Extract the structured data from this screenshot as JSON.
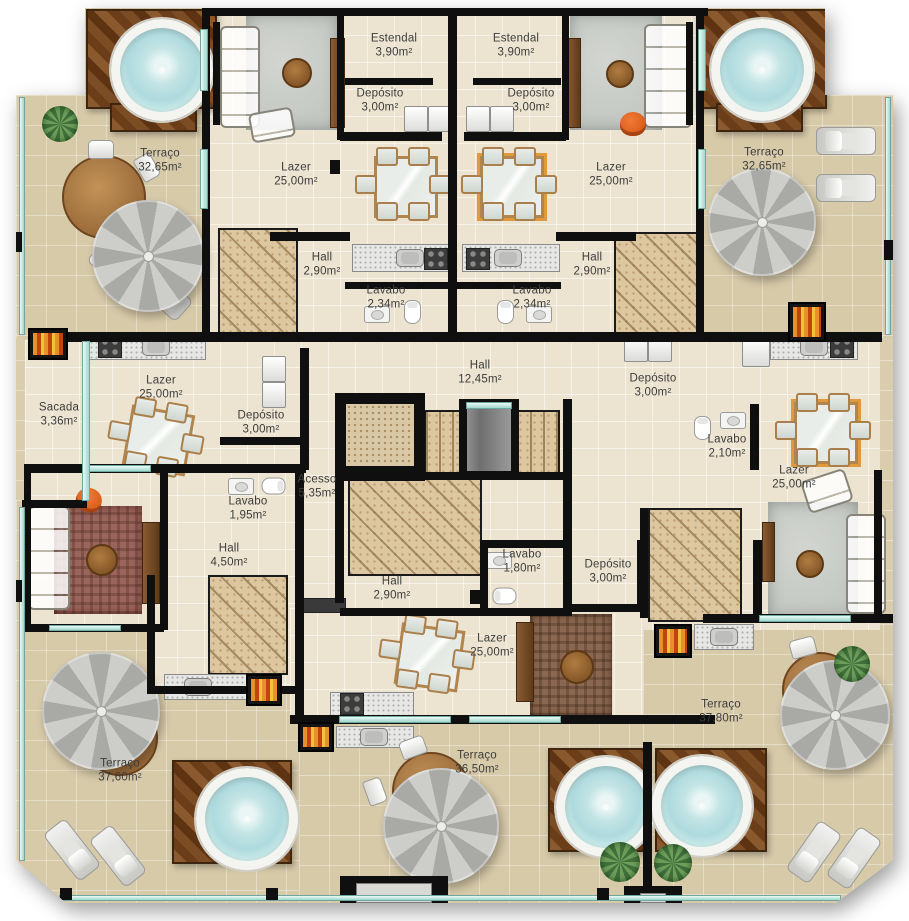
{
  "plan_meta": {
    "drawing_type": "residential penthouse floor plan, top view",
    "language": "pt-BR",
    "units": 4
  },
  "labels": [
    {
      "id": "estendal-top-left",
      "name": "Estendal",
      "area": "3,90m²"
    },
    {
      "id": "estendal-top-right",
      "name": "Estendal",
      "area": "3,90m²"
    },
    {
      "id": "deposito-top-left",
      "name": "Depósito",
      "area": "3,00m²"
    },
    {
      "id": "deposito-top-right",
      "name": "Depósito",
      "area": "3,00m²"
    },
    {
      "id": "terraco-top-left",
      "name": "Terraço",
      "area": "32,65m²"
    },
    {
      "id": "terraco-top-right",
      "name": "Terraço",
      "area": "32,65m²"
    },
    {
      "id": "lazer-top-left",
      "name": "Lazer",
      "area": "25,00m²"
    },
    {
      "id": "lazer-top-right",
      "name": "Lazer",
      "area": "25,00m²"
    },
    {
      "id": "hall-top-left",
      "name": "Hall",
      "area": "2,90m²"
    },
    {
      "id": "hall-top-right",
      "name": "Hall",
      "area": "2,90m²"
    },
    {
      "id": "lavabo-top-left",
      "name": "Lavabo",
      "area": "2,34m²"
    },
    {
      "id": "lavabo-top-right",
      "name": "Lavabo",
      "area": "2,34m²"
    },
    {
      "id": "hall-central",
      "name": "Hall",
      "area": "12,45m²"
    },
    {
      "id": "sacada",
      "name": "Sacada",
      "area": "3,36m²"
    },
    {
      "id": "lazer-mid-left",
      "name": "Lazer",
      "area": "25,00m²"
    },
    {
      "id": "deposito-mid-left",
      "name": "Depósito",
      "area": "3,00m²"
    },
    {
      "id": "deposito-mid-right",
      "name": "Depósito",
      "area": "3,00m²"
    },
    {
      "id": "lavabo-mid-right",
      "name": "Lavabo",
      "area": "2,10m²"
    },
    {
      "id": "lazer-mid-right",
      "name": "Lazer",
      "area": "25,00m²"
    },
    {
      "id": "acesso",
      "name": "Acesso",
      "area": "5,35m²"
    },
    {
      "id": "lavabo-mid-left",
      "name": "Lavabo",
      "area": "1,95m²"
    },
    {
      "id": "hall-left",
      "name": "Hall",
      "area": "4,50m²"
    },
    {
      "id": "hall-bottom-center",
      "name": "Hall",
      "area": "2,90m²"
    },
    {
      "id": "lavabo-bottom-center",
      "name": "Lavabo",
      "area": "1,80m²"
    },
    {
      "id": "deposito-bottom-right",
      "name": "Depósito",
      "area": "3,00m²"
    },
    {
      "id": "lazer-bottom-center",
      "name": "Lazer",
      "area": "25,00m²"
    },
    {
      "id": "terraco-bottom-right",
      "name": "Terraço",
      "area": "37,80m²"
    },
    {
      "id": "terraco-bottom-left",
      "name": "Terraço",
      "area": "37,60m²"
    },
    {
      "id": "terraco-bottom-center",
      "name": "Terraço",
      "area": "36,50m²"
    }
  ],
  "colors": {
    "wall": "#0f0f0f",
    "interior_floor": "#ece4d0",
    "terrace_floor": "#d7caa9",
    "deck_wood": "#6b3d18",
    "tub_water": "#bfe2e2",
    "window_glass": "#9fd8cd",
    "stair_travertine": "#ddc7a0",
    "accent_orange": "#d95f1e",
    "highlight_table_border": "#e09a3e",
    "label_text": "#3c3c3c"
  }
}
